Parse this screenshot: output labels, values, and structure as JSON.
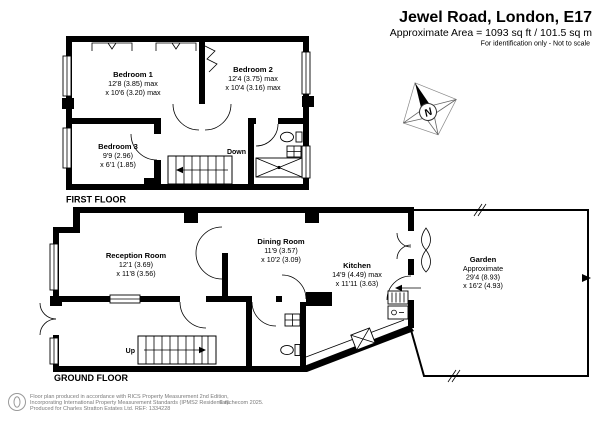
{
  "header": {
    "title": "Jewel Road, London, E17",
    "area_line": "Approximate Area = 1093 sq ft / 101.5 sq m",
    "note": "For identification only - Not to scale"
  },
  "floors": {
    "first_label": "FIRST FLOOR",
    "ground_label": "GROUND FLOOR"
  },
  "rooms": {
    "bedroom1": {
      "name": "Bedroom 1",
      "dim1": "12'8 (3.85) max",
      "dim2": "x 10'6 (3.20) max"
    },
    "bedroom2": {
      "name": "Bedroom 2",
      "dim1": "12'4 (3.75) max",
      "dim2": "x 10'4 (3.16) max"
    },
    "bedroom3": {
      "name": "Bedroom 3",
      "dim1": "9'9 (2.96)",
      "dim2": "x 6'1 (1.85)"
    },
    "reception": {
      "name": "Reception Room",
      "dim1": "12'1 (3.69)",
      "dim2": "x 11'8 (3.56)"
    },
    "dining": {
      "name": "Dining Room",
      "dim1": "11'9 (3.57)",
      "dim2": "x 10'2 (3.09)"
    },
    "kitchen": {
      "name": "Kitchen",
      "dim1": "14'9 (4.49) max",
      "dim2": "x 11'11 (3.63)"
    },
    "garden": {
      "name": "Garden",
      "dim1": "Approximate",
      "dim2": "29'4 (8.93)",
      "dim3": "x 16'2 (4.93)"
    }
  },
  "stairs": {
    "down": "Down",
    "up": "Up"
  },
  "compass": {
    "north": "N"
  },
  "footer": {
    "line1": "Floor plan produced in accordance with RICS Property Measurement 2nd Edition,",
    "line2": "Incorporating International Property Measurement Standards (IPMS2 Residential).",
    "copyright": "© nichecom 2025.",
    "line3": "Produced for Charles Stratton Estates Ltd.   REF: 1334228"
  },
  "colors": {
    "wall": "#000000",
    "background": "#ffffff",
    "muted_text": "#7a7a7a"
  }
}
